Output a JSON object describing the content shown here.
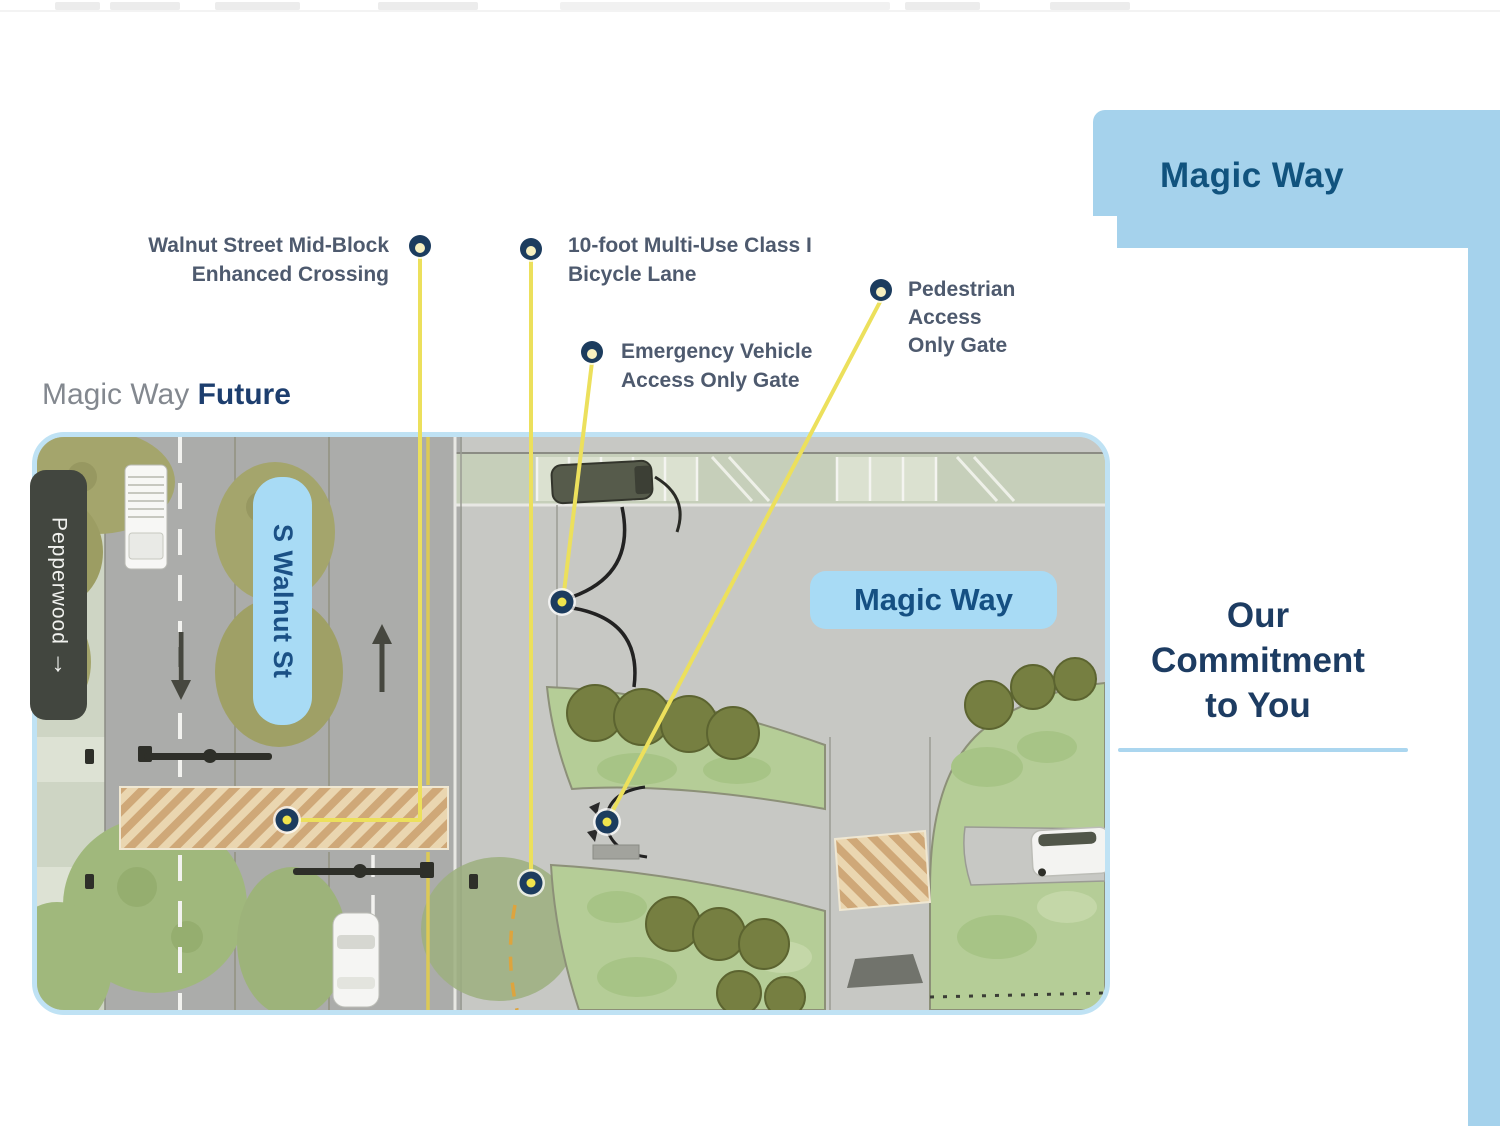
{
  "heading": {
    "prefix": "Magic Way ",
    "bold": "Future"
  },
  "annotations": {
    "crossing": {
      "line1": "Walnut Street Mid-Block",
      "line2": "Enhanced Crossing"
    },
    "bike": {
      "line1": "10-foot Multi-Use Class I",
      "line2": "Bicycle Lane"
    },
    "emergency": {
      "line1": "Emergency Vehicle",
      "line2": "Access Only Gate"
    },
    "pedestrian": {
      "line1": "Pedestrian",
      "line2": "Access",
      "line3": "Only Gate"
    }
  },
  "map": {
    "street_label": "S Walnut St",
    "road_label": "Magic Way",
    "cross_street": {
      "label": "Pepperwood",
      "arrow": "↓"
    }
  },
  "panel": {
    "title": "Magic Way",
    "line1": "Our",
    "line2": "Commitment",
    "line3": "to You"
  },
  "colors": {
    "panel_blue": "#a5d2ec",
    "title_navy": "#11537e",
    "commit_navy": "#1d3c62",
    "label_slate": "#4e5a6e",
    "leader_yellow": "#ece05c",
    "marker_navy": "#1c3c5e",
    "marker_center_label": "#f7f0c0",
    "marker_center_map": "#f0e44d",
    "map_border_blue": "#bfe2f4",
    "pill_blue": "#a8dbf5",
    "pill_text": "#155083"
  }
}
